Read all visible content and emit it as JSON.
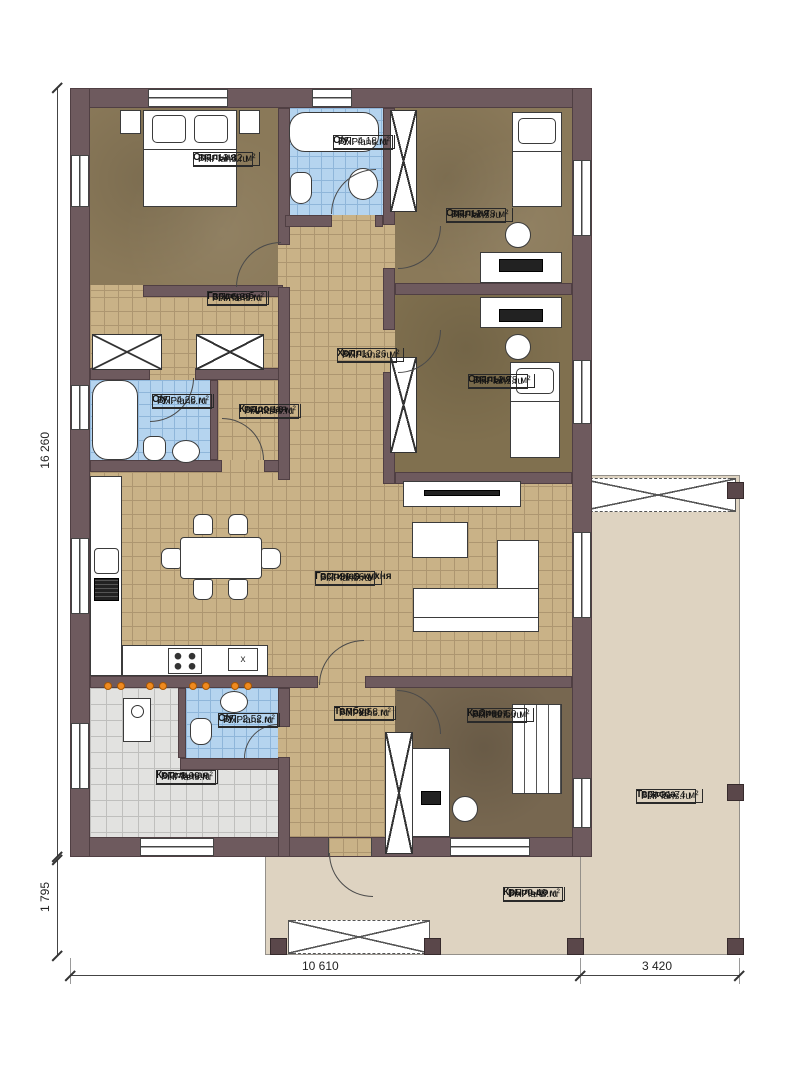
{
  "brand": "FixPlans.ru",
  "rooms": [
    {
      "id": "bedroom-1",
      "name": "Спальня",
      "area": "ВП: 13,32 м²"
    },
    {
      "id": "bath-top",
      "name": "С/у",
      "area": "ВП: 4,18 м²"
    },
    {
      "id": "bedroom-2",
      "name": "Спальня",
      "area": "ВП: 12,78 м²"
    },
    {
      "id": "wardrobe",
      "name": "Гардероб",
      "area": "ВП: 6,29 м²"
    },
    {
      "id": "hall",
      "name": "Холл",
      "area": "ВП: 10,26 м²"
    },
    {
      "id": "bedroom-3",
      "name": "Спальня",
      "area": "ВП: 12,78 м²"
    },
    {
      "id": "bath-left",
      "name": "С/у",
      "area": "ВП: 4,28 м²"
    },
    {
      "id": "storage",
      "name": "Кладовая",
      "area": "ВП: 2,16 м²"
    },
    {
      "id": "living-kitchen",
      "name": "Гостиная-кухня",
      "area": "ВП: 39,56 м²"
    },
    {
      "id": "boiler-room",
      "name": "Котельная",
      "area": "ВП: 8,99 м²"
    },
    {
      "id": "bath-bottom",
      "name": "С/у",
      "area": "ВП: 2,52 м²"
    },
    {
      "id": "vestibule",
      "name": "Тамбур",
      "area": "ВП: 8,58 м²"
    },
    {
      "id": "office",
      "name": "Кабинет",
      "area": "ВП: 10,50 м²"
    },
    {
      "id": "terrace",
      "name": "Терасса",
      "area": "ВП: 31,74 м²"
    },
    {
      "id": "porch",
      "name": "Крыльцо",
      "area": "ВП: 9,49 м²"
    }
  ],
  "dimensions": {
    "left": "16 260",
    "bottom_left": "1 795",
    "bottom_main": "10 610",
    "bottom_right": "3 420"
  },
  "kitchen": {
    "appliance_mark": "x"
  },
  "colors": {
    "wall": "#6e5a5e",
    "floor_tile_tan": "#c9b287",
    "floor_wood_brown": "#8a7959",
    "floor_bath_blue": "#b5d4ef",
    "floor_boiler_gray": "#e2e2e0",
    "terrace_beige": "#ded3c1",
    "heating_orange": "#ef8a1f"
  }
}
